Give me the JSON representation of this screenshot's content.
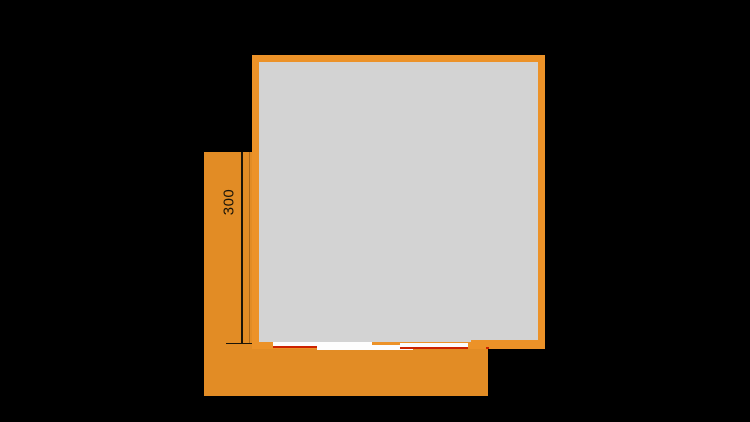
{
  "diagram": {
    "type": "floor-plan-section",
    "dimension_label": "300"
  },
  "colors": {
    "background": "#000000",
    "terrace_orange": "#E28C25",
    "wall_orange": "#EC9228",
    "floor_gray": "#D3D3D3",
    "panel_white": "#FDFDFD",
    "rail_red": "#CC2200",
    "ink": "#1A1408"
  }
}
